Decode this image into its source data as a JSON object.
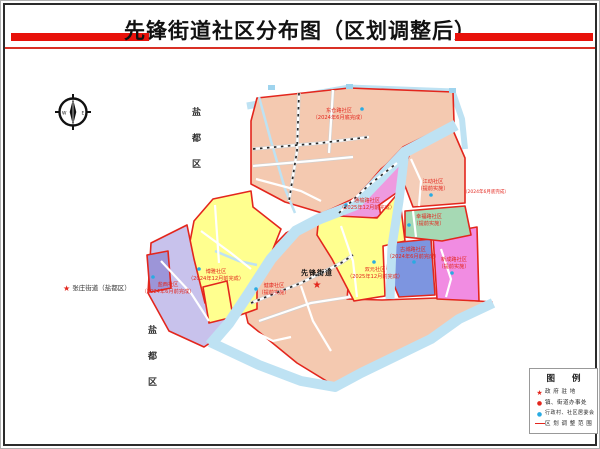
{
  "header": {
    "title": "先锋街道社区分布图（区划调整后）"
  },
  "compass": {
    "west": "W",
    "east": "E"
  },
  "outside_labels": {
    "district_top": "盐都区",
    "district_bottom": "盐都区",
    "neighbor_star": "★",
    "neighbor": "张庄街道（盐都区）"
  },
  "map": {
    "street_label": "先锋街道",
    "street_star": "★",
    "road_note": "（2024年6月底完成）",
    "regions": [
      {
        "id": "dongcang",
        "name": "东仓路社区",
        "note": "（2024年6月底完成）",
        "color": "#F4C9B0"
      },
      {
        "id": "jiangdong",
        "name": "江动社区",
        "note": "（提前实施）",
        "color": "#F4CDB8"
      },
      {
        "id": "xingfu",
        "name": "幸福路社区",
        "note": "（提前实施）",
        "color": "#A6D9B4"
      },
      {
        "id": "tongyu",
        "name": "通榆路社区",
        "note": "（2025年12月前完成）",
        "color": "#EE9ADF"
      },
      {
        "id": "shuangyuan",
        "name": "双元社区",
        "note": "（2025年12月前完成）",
        "color": "#FFFF8F"
      },
      {
        "id": "gucheng",
        "name": "古城路社区",
        "note": "（2024年6月前完成）",
        "color": "#7D95E0"
      },
      {
        "id": "xincheng",
        "name": "新成路社区",
        "note": "（提前实施）",
        "color": "#F18CE2"
      },
      {
        "id": "jiankang",
        "name": "健康社区",
        "note": "（提前实施）",
        "color": "#F4C9B0"
      },
      {
        "id": "boya",
        "name": "博雅社区",
        "note": "（2024年12月前完成）",
        "color": "#FFFF8F"
      },
      {
        "id": "yanxi",
        "name": "盐西社区",
        "note": "（2024年6月前完成）",
        "color": "#C8C2EC"
      }
    ],
    "colors": {
      "boundary_red": "#E3261D",
      "river_blue": "#BEE2F3",
      "small_purple": "#9C95D8",
      "committee_dot_blue": "#29ABE2"
    }
  },
  "legend": {
    "title": "图 例",
    "items": [
      {
        "symbol": "red-star",
        "label": "政 府 驻 地"
      },
      {
        "symbol": "red-dot",
        "label": "镇、街道办事处"
      },
      {
        "symbol": "blue-dot",
        "label": "行政村、社区居委会"
      },
      {
        "symbol": "red-line",
        "label": "区 划 调 整 范 围"
      }
    ]
  }
}
